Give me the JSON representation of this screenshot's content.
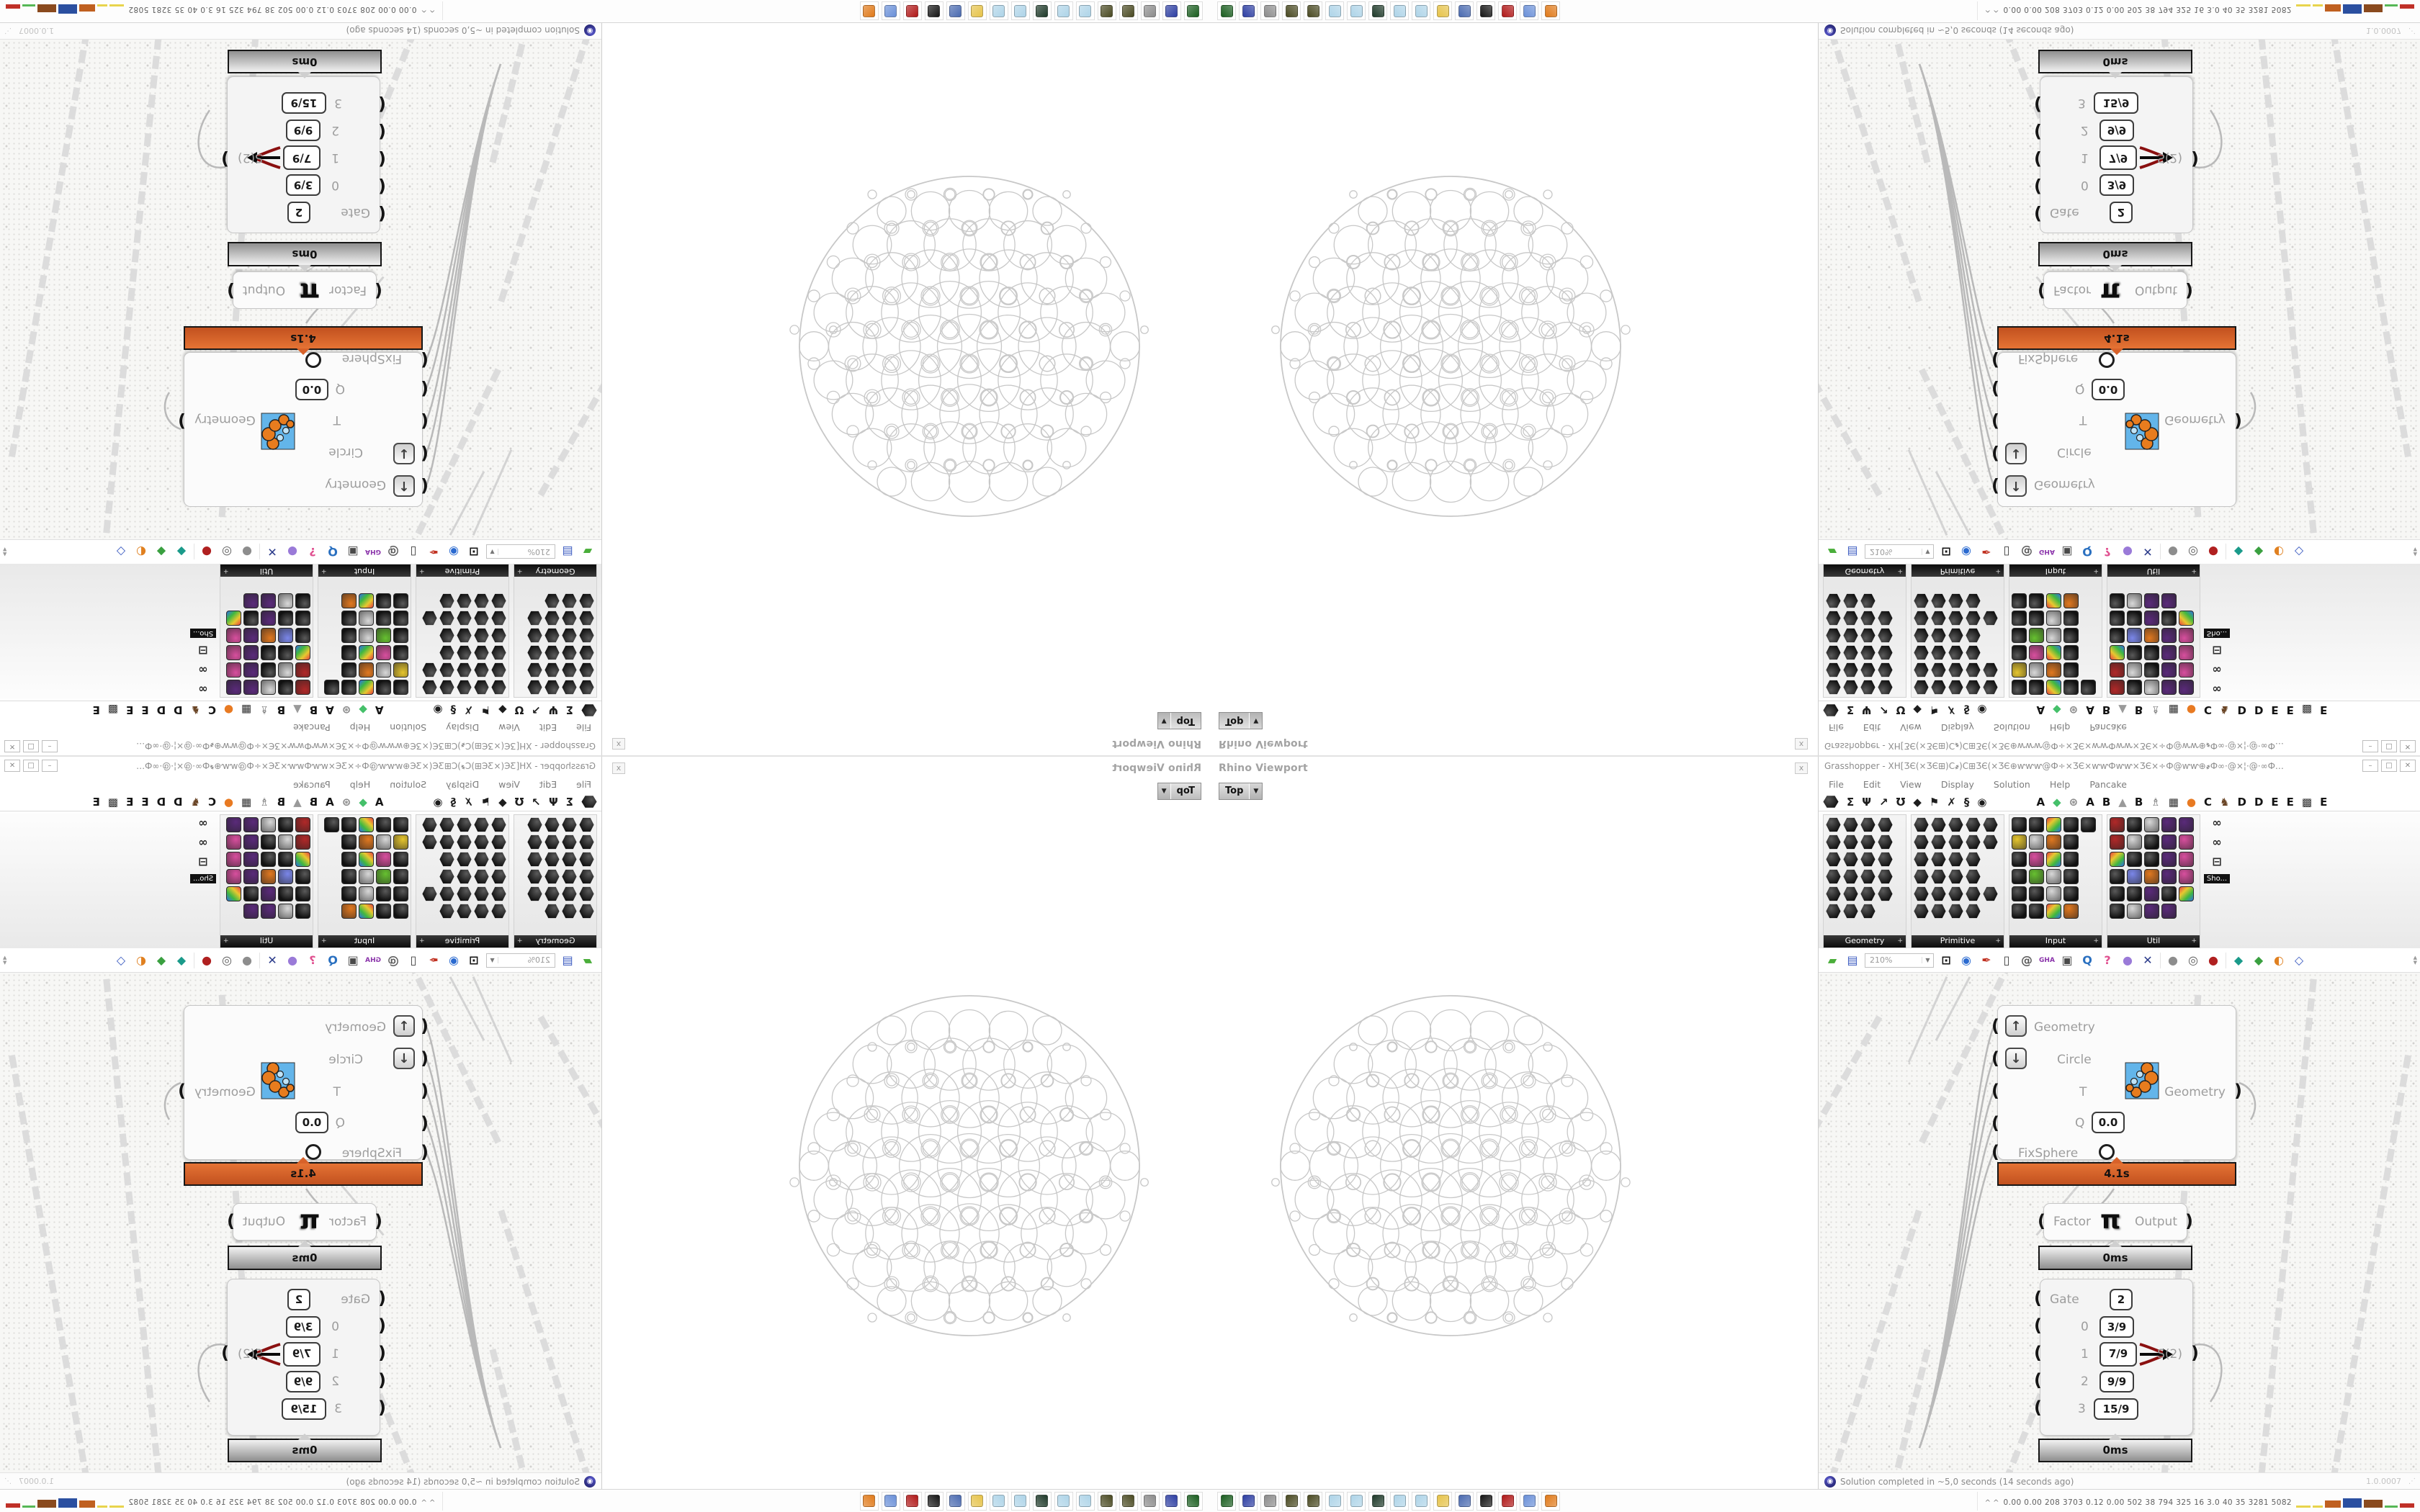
{
  "rhino": {
    "panel_title": "Rhino Viewport",
    "viewport_tab": "Top",
    "dropdown_glyph": "▼",
    "close_glyph": "x"
  },
  "gh": {
    "title": "Grasshopper - XH[ƷЄ(×ƷЄ⊞)C҂)C⊞ƷЄ(×ƷЄ⊕ⱳⱳⱳ@Ф÷×ƷЄ×ⱳⱳФⱳⱳ×ƷЄ×÷Ф@ⱳⱳ⊕҂Ф∞·@×¦·@·∞ФѺ҂⊕.:.⊕҂ФⱳⱳƷЄ[ƷЄⱳⱳѺ҂⊕...",
    "window_buttons": [
      "–",
      "□",
      "✕"
    ],
    "menus": [
      "File",
      "Edit",
      "View",
      "Display",
      "Solution",
      "Help",
      "Pancake"
    ],
    "tabs": [
      {
        "g": "",
        "hex": true,
        "c": "#111"
      },
      {
        "g": "Σ",
        "c": "#1d1d1d"
      },
      {
        "g": "Ψ",
        "c": "#1d1d1d"
      },
      {
        "g": "↗",
        "c": "#1d1d1d"
      },
      {
        "g": "Ʊ",
        "c": "#1d1d1d"
      },
      {
        "g": "◆",
        "c": "#1d1d1d"
      },
      {
        "g": "⚑",
        "c": "#1d1d1d"
      },
      {
        "g": "✗",
        "c": "#1d1d1d"
      },
      {
        "g": "§",
        "c": "#1d1d1d"
      },
      {
        "g": "◉",
        "c": "#1d1d1d"
      },
      {
        "g": "A",
        "c": "#141414",
        "sp": true
      },
      {
        "g": "◆",
        "c": "#45c06a"
      },
      {
        "g": "⊛",
        "c": "#8a8a8a"
      },
      {
        "g": "A",
        "c": "#141414"
      },
      {
        "g": "B",
        "c": "#141414"
      },
      {
        "g": "▲",
        "c": "#9a9a9a"
      },
      {
        "g": "B",
        "c": "#141414"
      },
      {
        "g": "♗",
        "c": "#6d6d6d"
      },
      {
        "g": "▦",
        "c": "#2d2d2d"
      },
      {
        "g": "●",
        "c": "#e87a22"
      },
      {
        "g": "C",
        "c": "#141414"
      },
      {
        "g": "♞",
        "c": "#6a4526"
      },
      {
        "g": "D",
        "c": "#141414"
      },
      {
        "g": "D",
        "c": "#141414"
      },
      {
        "g": "E",
        "c": "#141414"
      },
      {
        "g": "E",
        "c": "#141414"
      },
      {
        "g": "▩",
        "c": "#2d2d2d"
      },
      {
        "g": "E",
        "c": "#141414"
      }
    ],
    "palette_groups": [
      {
        "label": "Geometry",
        "cols": 4,
        "shape": "hex",
        "width": 116,
        "cells": [
          "k",
          "k",
          "k",
          "k",
          "k",
          "k",
          "k",
          "k",
          "k",
          "k",
          "k",
          "k",
          "k",
          "k",
          "k",
          "k",
          "k",
          "k",
          "k",
          "k",
          "k",
          "k",
          "k",
          "."
        ]
      },
      {
        "label": "Primitive",
        "cols": 5,
        "shape": "hex",
        "width": 130,
        "cells": [
          "k",
          "k",
          "k",
          "k",
          "k",
          "k",
          "k",
          "k",
          "k",
          "k",
          "k",
          "k",
          "k",
          "k",
          ".",
          "k",
          "k",
          "k",
          "k",
          ".",
          "k",
          "k",
          "k",
          "k",
          "k",
          "k",
          "k",
          "k",
          "k",
          "."
        ]
      },
      {
        "label": "Input",
        "cols": 5,
        "shape": "sq",
        "width": 130,
        "cells": [
          "k",
          "k",
          "m",
          "k",
          "k",
          "y",
          "w",
          "o",
          "k",
          ".",
          "k",
          "p",
          "m",
          "k",
          ".",
          "k",
          "g",
          "w",
          "k",
          ".",
          "k",
          "k",
          "w",
          "k",
          ".",
          "k",
          "k",
          "m",
          "o",
          "."
        ]
      },
      {
        "label": "Util",
        "cols": 5,
        "shape": "sq",
        "width": 130,
        "cells": [
          "r",
          "k",
          "w",
          "u",
          "u",
          "r",
          "w",
          "k",
          "u",
          "p",
          "m",
          "k",
          "k",
          "u",
          "p",
          "k",
          "b",
          "o",
          "u",
          "p",
          "k",
          "k",
          "u",
          "k",
          "m",
          "k",
          "w",
          "u",
          "u",
          "."
        ]
      }
    ],
    "palette_side": {
      "icons": [
        "∞",
        "∞",
        "⊟"
      ],
      "tooltip": "Sho..."
    },
    "toolbar": {
      "zoom_value": "210%",
      "items": [
        {
          "g": "▰",
          "c": "#4aae3a"
        },
        {
          "g": "▤",
          "c": "#3a5ac0"
        },
        {
          "combo": true
        },
        {
          "g": "⊡",
          "c": "#141414"
        },
        {
          "g": "◉",
          "c": "#2a6ad0"
        },
        {
          "g": "✒",
          "c": "#c03020"
        },
        {
          "g": "▯",
          "c": "#3d3d3d"
        },
        {
          "g": "@",
          "c": "#5a5a5a"
        },
        {
          "g": "GHA",
          "c": "#8a33aa",
          "small": true
        },
        {
          "g": "▣",
          "c": "#4a4a4a"
        },
        {
          "g": "Q",
          "c": "#2a70c0"
        },
        {
          "g": "?",
          "c": "#e05090"
        },
        {
          "g": "●",
          "c": "#9a7ad8"
        },
        {
          "g": "✕",
          "c": "#2a3a8a"
        },
        {
          "sep": true
        },
        {
          "g": "●",
          "c": "#8d8d8d"
        },
        {
          "g": "◎",
          "c": "#5a5a5a"
        },
        {
          "g": "●",
          "c": "#b02020"
        },
        {
          "sep": true
        },
        {
          "g": "◆",
          "c": "#1a9a8a"
        },
        {
          "g": "◆",
          "c": "#3aa040"
        },
        {
          "g": "◐",
          "c": "#e08020"
        },
        {
          "g": "◇",
          "c": "#3a5ac0"
        }
      ],
      "scroll_up": "▲",
      "scroll_down": "▼"
    },
    "status": {
      "text": "Solution completed in ~5,0 seconds (14 seconds ago)",
      "version": "1.0.0007"
    }
  },
  "canvas": {
    "main_component": {
      "in1": "Geometry",
      "in2": "Circle",
      "in3": "T",
      "in4": "Q",
      "in5": "FixSphere",
      "q_value": "0.0",
      "up_glyph": "↑",
      "down_glyph": "↓",
      "output": "Geometry",
      "time": "4.1s"
    },
    "pi_component": {
      "input": "Factor",
      "glyph": "π",
      "output": "Output",
      "time": "0ms"
    },
    "gate_component": {
      "gate_label": "Gate",
      "gate_value": "2",
      "rows": [
        {
          "idx": "0",
          "val": "3/9"
        },
        {
          "idx": "1",
          "val": "7/9"
        },
        {
          "idx": "2",
          "val": "9/9"
        },
        {
          "idx": "3",
          "val": "15/9"
        }
      ],
      "output": "S(2)",
      "time": "0ms"
    }
  },
  "taskbar": {
    "icon_colors": [
      "#1b5e20",
      "#2e3fa3",
      "#8d8d8d",
      "#4a4a22",
      "#4a4a22",
      "#aed4e8",
      "#aed4e8",
      "#1f3a2a",
      "#aed4e8",
      "#aed4e8",
      "#e6c34a",
      "#4a6ab0",
      "#141414",
      "#b01818",
      "#6a90d8",
      "#e07a1a"
    ],
    "tray": {
      "chevron": "^",
      "stats": "0.00 0.00 208 3703 0.12 0.00 502 38 794 325 16 3.0 40 35 3281 5082",
      "blocks": [
        {
          "c": "#e8d44d",
          "w": 20,
          "h": 3
        },
        {
          "c": "#e8d44d",
          "w": 14,
          "h": 3
        },
        {
          "c": "#c06020",
          "w": 22,
          "h": 10
        },
        {
          "c": "#2b4fa0",
          "w": 26,
          "h": 13
        },
        {
          "c": "#8a4a1e",
          "w": 26,
          "h": 11
        },
        {
          "c": "#57b857",
          "w": 18,
          "h": 3
        },
        {
          "c": "#c03028",
          "w": 20,
          "h": 6
        }
      ]
    }
  },
  "colors": {
    "hot_bar": "#d8622a",
    "cold_bar": "#c9c9c9",
    "wire": "#b9b9b9",
    "sphere_stroke": "#c8c8c8",
    "gate_arrow_red": "#8a1010"
  }
}
